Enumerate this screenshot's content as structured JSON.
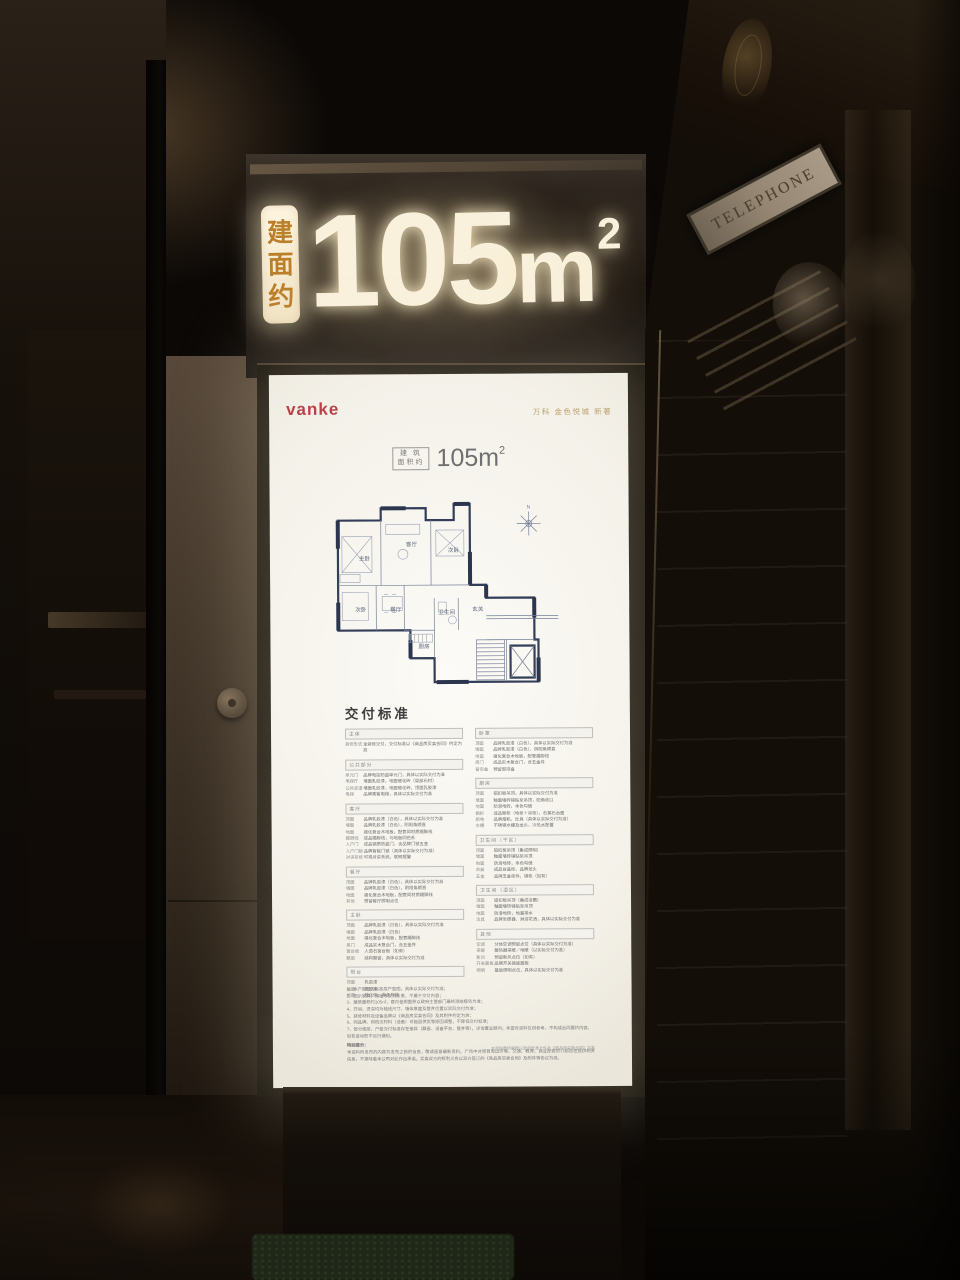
{
  "sign": {
    "prefix_chars": [
      "建",
      "面",
      "约"
    ],
    "area": "105",
    "unit": "m",
    "sup": "2"
  },
  "poster": {
    "brand": "vanke",
    "project_title": "万科 金色悦城 新著",
    "area_box": {
      "line1": "建 筑",
      "line2": "面积约",
      "value": "105m",
      "sup": "2"
    },
    "floorplan": {
      "compass_n": "N",
      "rooms": [
        {
          "label": "主卧",
          "x": 33,
          "y": 70
        },
        {
          "label": "客厅",
          "x": 80,
          "y": 56
        },
        {
          "label": "次卧",
          "x": 122,
          "y": 62
        },
        {
          "label": "次卧",
          "x": 29,
          "y": 121
        },
        {
          "label": "餐厅",
          "x": 64,
          "y": 121
        },
        {
          "label": "厨房",
          "x": 92,
          "y": 158
        },
        {
          "label": "卫生间",
          "x": 112,
          "y": 124
        },
        {
          "label": "玄关",
          "x": 146,
          "y": 121
        }
      ]
    },
    "delivery": {
      "title": "交付标准",
      "columns": [
        [
          {
            "name": "主体",
            "rows": [
              [
                "装修形式",
                "全装修交付，交付标准以《商品房买卖合同》约定为准"
              ]
            ]
          },
          {
            "name": "公共部分",
            "rows": [
              [
                "单元门",
                "品牌电控防盗单元门，具体以实际交付为准"
              ],
              [
                "电梯厅",
                "墙面乳胶漆，地面玻化砖（局部石材）"
              ],
              [
                "公共走道",
                "墙面乳胶漆，地面玻化砖，顶面乳胶漆"
              ],
              [
                "电梯",
                "品牌乘客电梯，具体以实际交付为准"
              ]
            ]
          },
          {
            "name": "客厅",
            "rows": [
              [
                "顶面",
                "品牌乳胶漆（白色），具体以实际交付为准"
              ],
              [
                "墙面",
                "品牌乳胶漆（白色），阴阳角顺直"
              ],
              [
                "地面",
                "强化复合木地板，配套同材质踢脚线"
              ],
              [
                "踢脚线",
                "成品踢脚线，与地板同色系"
              ],
              [
                "入户门",
                "成品钢质防盗门，含品牌门锁五金"
              ],
              [
                "入户门锁",
                "品牌智能门锁（具体以实际交付为准）"
              ],
              [
                "对讲系统",
                "可视对讲系统，联网报警"
              ]
            ]
          },
          {
            "name": "餐厅",
            "rows": [
              [
                "顶面",
                "品牌乳胶漆（白色），具体以实际交付为准"
              ],
              [
                "墙面",
                "品牌乳胶漆（白色），阴阳角顺直"
              ],
              [
                "地面",
                "强化复合木地板，配套同材质踢脚线"
              ],
              [
                "其他",
                "预留餐厅照明点位"
              ]
            ]
          },
          {
            "name": "主卧",
            "rows": [
              [
                "顶面",
                "品牌乳胶漆（白色），具体以实际交付为准"
              ],
              [
                "墙面",
                "品牌乳胶漆（白色）"
              ],
              [
                "地面",
                "强化复合木地板，配套踢脚线"
              ],
              [
                "房门",
                "成品实木复合门，含五金件"
              ],
              [
                "窗台板",
                "人造石窗台板（如有）"
              ],
              [
                "飘窗",
                "结构飘窗，具体以实际交付为准"
              ]
            ]
          },
          {
            "name": "阳台",
            "rows": [
              [
                "顶面",
                "乳胶漆"
              ],
              [
                "墙面",
                "乳胶漆"
              ],
              [
                "地面",
                "玻化砖，本色勾缝"
              ]
            ]
          }
        ],
        [
          {
            "name": "卧室",
            "rows": [
              [
                "顶面",
                "品牌乳胶漆（白色），具体以实际交付为准"
              ],
              [
                "墙面",
                "品牌乳胶漆（白色），阴阳角顺直"
              ],
              [
                "地面",
                "强化复合木地板，配套踢脚线"
              ],
              [
                "房门",
                "成品实木复合门，含五金件"
              ],
              [
                "窗帘盒",
                "预留窗帘盒"
              ]
            ]
          },
          {
            "name": "厨房",
            "rows": [
              [
                "顶面",
                "铝扣板吊顶，具体以实际交付为准"
              ],
              [
                "墙面",
                "釉面墙砖铺贴至吊顶，阳角收口"
              ],
              [
                "地面",
                "防滑地砖，本色勾缝"
              ],
              [
                "橱柜",
                "成品橱柜（地柜＋吊柜），石英石台面"
              ],
              [
                "厨电",
                "品牌烟机、灶具（具体以实际交付为准）"
              ],
              [
                "水槽",
                "不锈钢水槽及龙头，冷热水配置"
              ]
            ]
          },
          {
            "name": "卫生间（干区）",
            "rows": [
              [
                "顶面",
                "铝扣板吊顶（集成照明）"
              ],
              [
                "墙面",
                "釉面墙砖铺贴至吊顶"
              ],
              [
                "地面",
                "防滑地砖，本色勾缝"
              ],
              [
                "台盆",
                "成品台盆柜、品牌龙头"
              ],
              [
                "五金",
                "品牌五金挂件，镜柜（如有）"
              ]
            ]
          },
          {
            "name": "卫生间（湿区）",
            "rows": [
              [
                "顶面",
                "铝扣板吊顶（集成浴霸）"
              ],
              [
                "墙面",
                "釉面墙砖铺贴至吊顶"
              ],
              [
                "地面",
                "防滑地砖，地漏排水"
              ],
              [
                "洁具",
                "品牌坐便器、淋浴花洒，具体以实际交付为准"
              ]
            ]
          },
          {
            "name": "其他",
            "rows": [
              [
                "空调",
                "分体空调预留点位（具体以实际交付为准）"
              ],
              [
                "采暖",
                "散热器采暖／地暖（以实际交付为准）"
              ],
              [
                "新风",
                "预留新风点位（如有）"
              ],
              [
                "开关面板",
                "品牌开关插座面板"
              ],
              [
                "照明",
                "基础照明点位，具体以实际交付为准"
              ]
            ]
          }
        ]
      ]
    },
    "notes": {
      "items": [
        "1、本户型图为标准层户型图，具体以实际交付为准；",
        "2、图示家具、绿植等仅为示意，不属于交付内容；",
        "3、建筑面积约105㎡，套内使用面积以政府主管部门最终测绘报告为准；",
        "4、开间、进深均为轴线尺寸，墙体厚度及管井位置以实际交付为准；",
        "5、装修材料及设备品牌以《商品房买卖合同》及其附件约定为准；",
        "6、同品牌、同档次材料（设备）可能因供货等原因调整，不降低交付标准；",
        "7、部分楼层、户型交付标准存在差异（飘窗、设备平台、管井等），详询置业顾问；本宣传资料仅供参考，不构成合同要约内容，如有变动恕不另行通知。"
      ],
      "special_title": "特别提示：",
      "special_body": "本资料所发布的内容为发布之前的信息，敬请留意最新资料。广告中对项目周边环境、交通、教育、商业配套的介绍旨在提供相关信息，不意味着本公司对此作出承诺。买卖双方的权利义务以双方签订的《商品房买卖合同》及附件等协议为准。",
      "footnote": "本资料最终解释以政府批准文件及《商品房买卖合同》为准"
    }
  },
  "booth": {
    "sign_text": "TELEPHONE"
  }
}
